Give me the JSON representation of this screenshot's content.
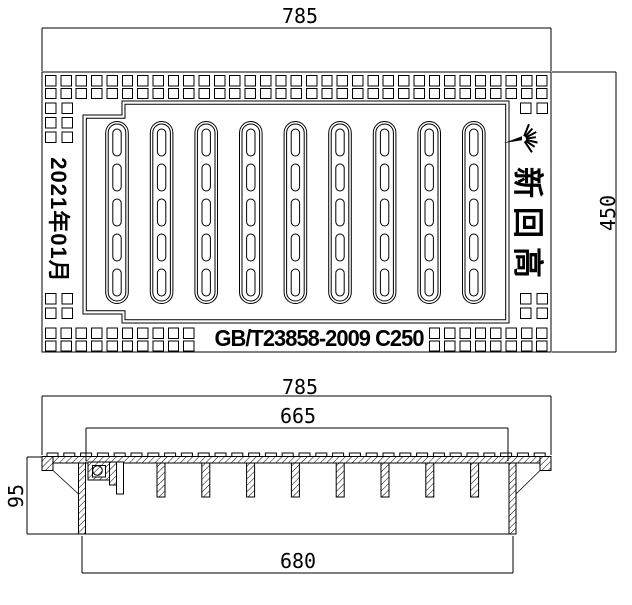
{
  "page": {
    "background_color": "#ffffff",
    "line_color": "#000000"
  },
  "top_view": {
    "dim_width_label": "785",
    "dim_height_label": "450",
    "cast_date_text": "2021年01月",
    "brand_text": "新回高",
    "standard_text": "GB/T23858-2009 C250",
    "bar_count": 9,
    "slots_per_bar": 5,
    "logo_icon": "starburst-logo"
  },
  "section_view": {
    "dim_top_width_label": "785",
    "dim_inner_width_label": "665",
    "dim_bottom_width_label": "680",
    "dim_height_label": "95",
    "rib_count": 8,
    "cleat_count": 30
  }
}
